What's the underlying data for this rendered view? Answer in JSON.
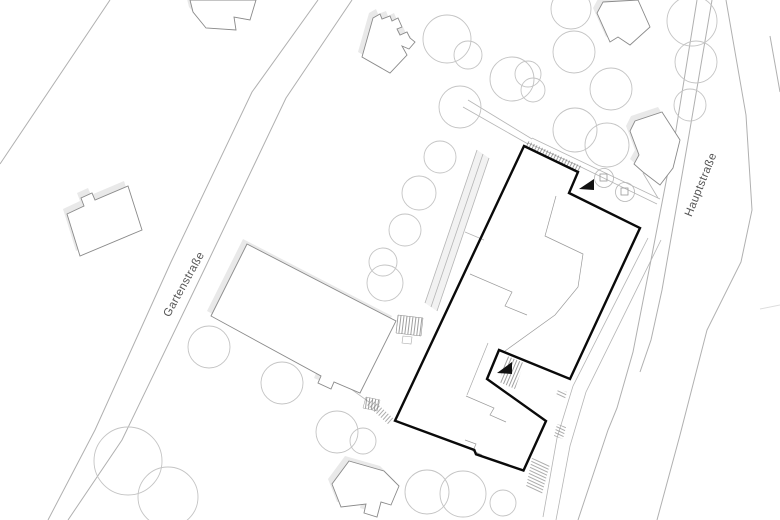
{
  "plan": {
    "streets": [
      {
        "name": "Gartenstraße"
      },
      {
        "name": "Hauptstraße"
      }
    ],
    "markers": [
      {
        "icon": "entrance-triangle",
        "count": 2
      }
    ],
    "colors": {
      "background": "#ffffff",
      "bold_building_outline": "#0a0a0a",
      "building_outline": "#8a8a8a",
      "building_shadow": "#e9e9e9",
      "tree_outline": "#c4c4c4",
      "street_line": "#b0b0b0",
      "path_line": "#b5b5b5",
      "hatch_line": "#777777",
      "label_text": "#555555"
    }
  }
}
